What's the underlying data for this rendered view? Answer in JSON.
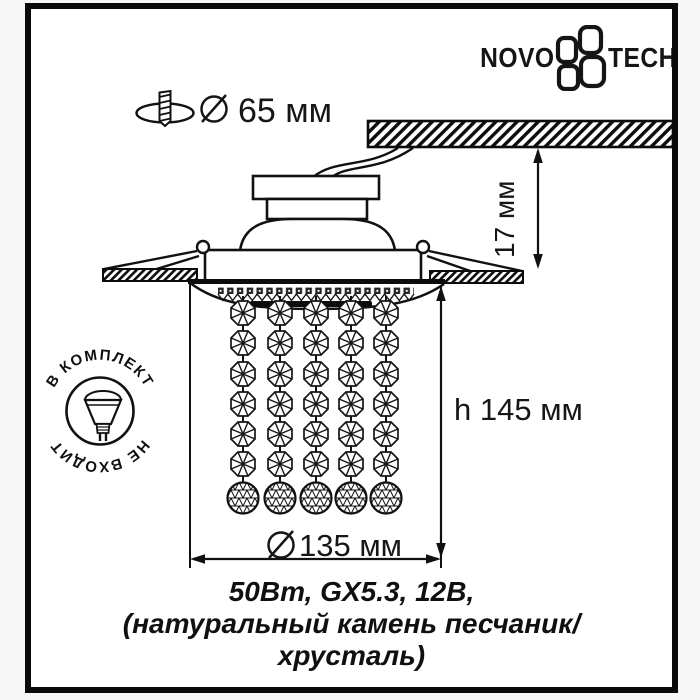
{
  "colors": {
    "ink": "#111111",
    "paper": "#ffffff"
  },
  "brand": {
    "wordmark_left": "NOVO",
    "wordmark_right": "TECH"
  },
  "dimensions": {
    "cutout": {
      "symbol": "⌀",
      "label": "65 мм"
    },
    "depth": {
      "label": "17 мм"
    },
    "height": {
      "label": "h 145 мм"
    },
    "diameter": {
      "symbol": "⌀",
      "label": "135 мм"
    }
  },
  "stamp": {
    "top_arc": "В КОМПЛЕКТ",
    "bottom_arc": "НЕ ВХОДИТ"
  },
  "caption": {
    "line1": "50Вт, GX5.3, 12В,",
    "line2": "(натуральный камень песчаник/",
    "line3": "хрусталь)"
  }
}
